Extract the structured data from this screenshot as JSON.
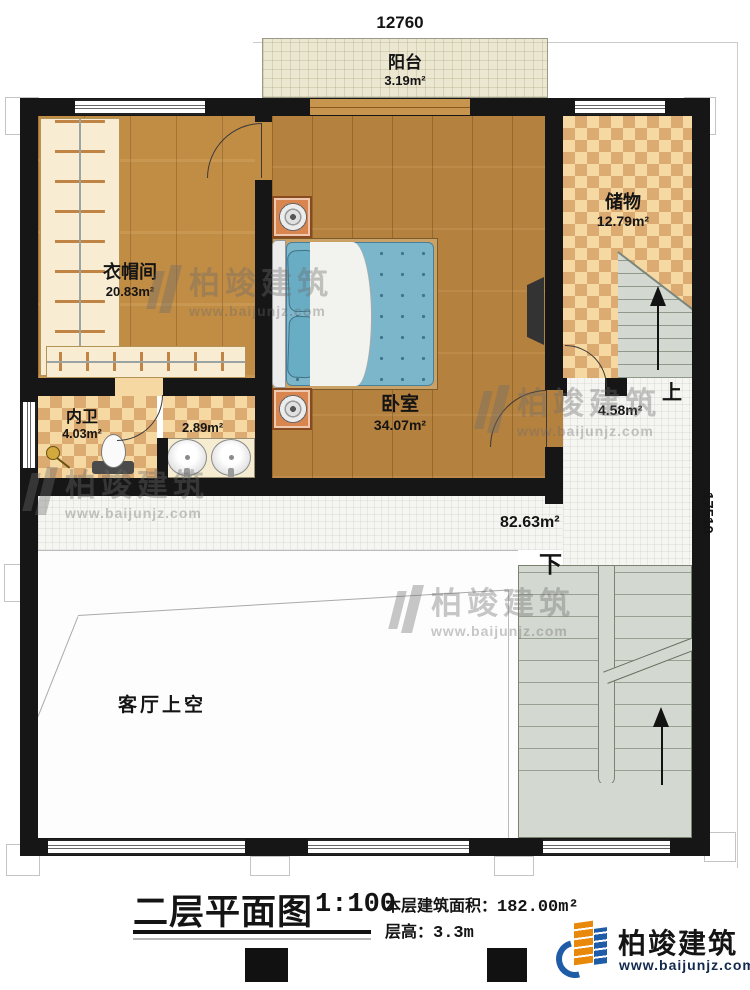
{
  "dimensions": {
    "top": "12760",
    "right": "17510"
  },
  "rooms": {
    "balcony": {
      "name": "阳台",
      "area": "3.19m²"
    },
    "cloakroom": {
      "name": "衣帽间",
      "area": "20.83m²"
    },
    "bedroom": {
      "name": "卧室",
      "area": "34.07m²"
    },
    "storage": {
      "name": "储物",
      "area": "12.79m²"
    },
    "bathroom": {
      "name": "内卫",
      "area": "4.03m²"
    },
    "vanity": {
      "area": "2.89m²"
    },
    "hall": {
      "area": "82.63m²"
    },
    "stair_hall": {
      "area": "4.58m²"
    },
    "living_void": {
      "name": "客厅上空"
    }
  },
  "stairs": {
    "up": "上",
    "down": "下"
  },
  "title": {
    "text": "二层平面图",
    "scale": "1:100",
    "area_label": "本层建筑面积：",
    "area_value": "182.00m²",
    "height_label": "层高：",
    "height_value": "3.3m"
  },
  "brand": {
    "name": "柏竣建筑",
    "url": "www.baijunjz.com"
  },
  "watermark": {
    "name": "柏竣建筑",
    "url": "www.baijunjz.com"
  },
  "colors": {
    "wall": "#161616",
    "wood_light": "#c18c44",
    "wood_dark": "#b5813e",
    "tile": "#dcab72",
    "stair": "#d3d9d0",
    "brand_blue": "#1f5ca8",
    "brand_orange": "#e8890c"
  }
}
